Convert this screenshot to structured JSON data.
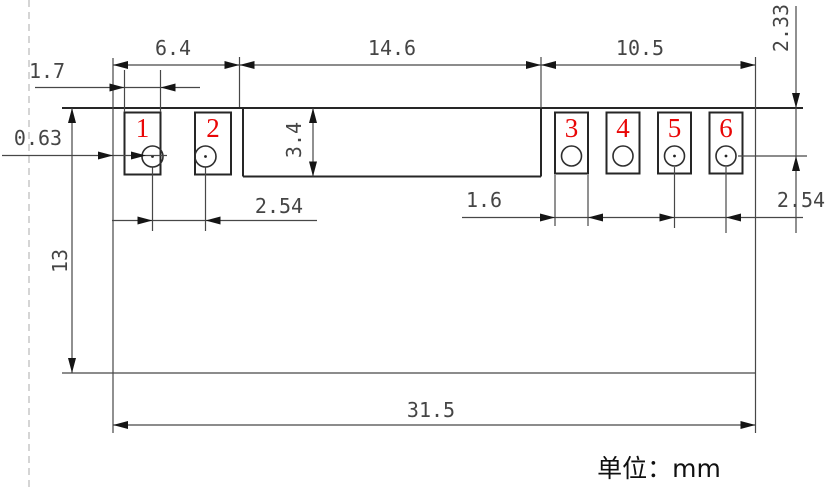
{
  "drawing": {
    "title_hint": "pad layout dimension drawing",
    "pads": {
      "labels": [
        "1",
        "2",
        "3",
        "4",
        "5",
        "6"
      ]
    },
    "dimensions": {
      "top_left_width": "6.4",
      "top_middle_width": "14.6",
      "top_right_width": "10.5",
      "left_pad_width": "1.7",
      "hole_offset": "0.63",
      "body_height": "13",
      "middle_depth": "3.4",
      "left_pad_pitch": "2.54",
      "right_pad_width": "1.6",
      "right_pad_pitch": "2.54",
      "pad_top_to_hole": "2.33",
      "overall_width": "31.5"
    },
    "footer": {
      "units_label": "单位：mm"
    },
    "colors": {
      "pad_number_red": "#e90606",
      "outline_dark": "#262626",
      "dimension_gray": "#454545"
    }
  }
}
